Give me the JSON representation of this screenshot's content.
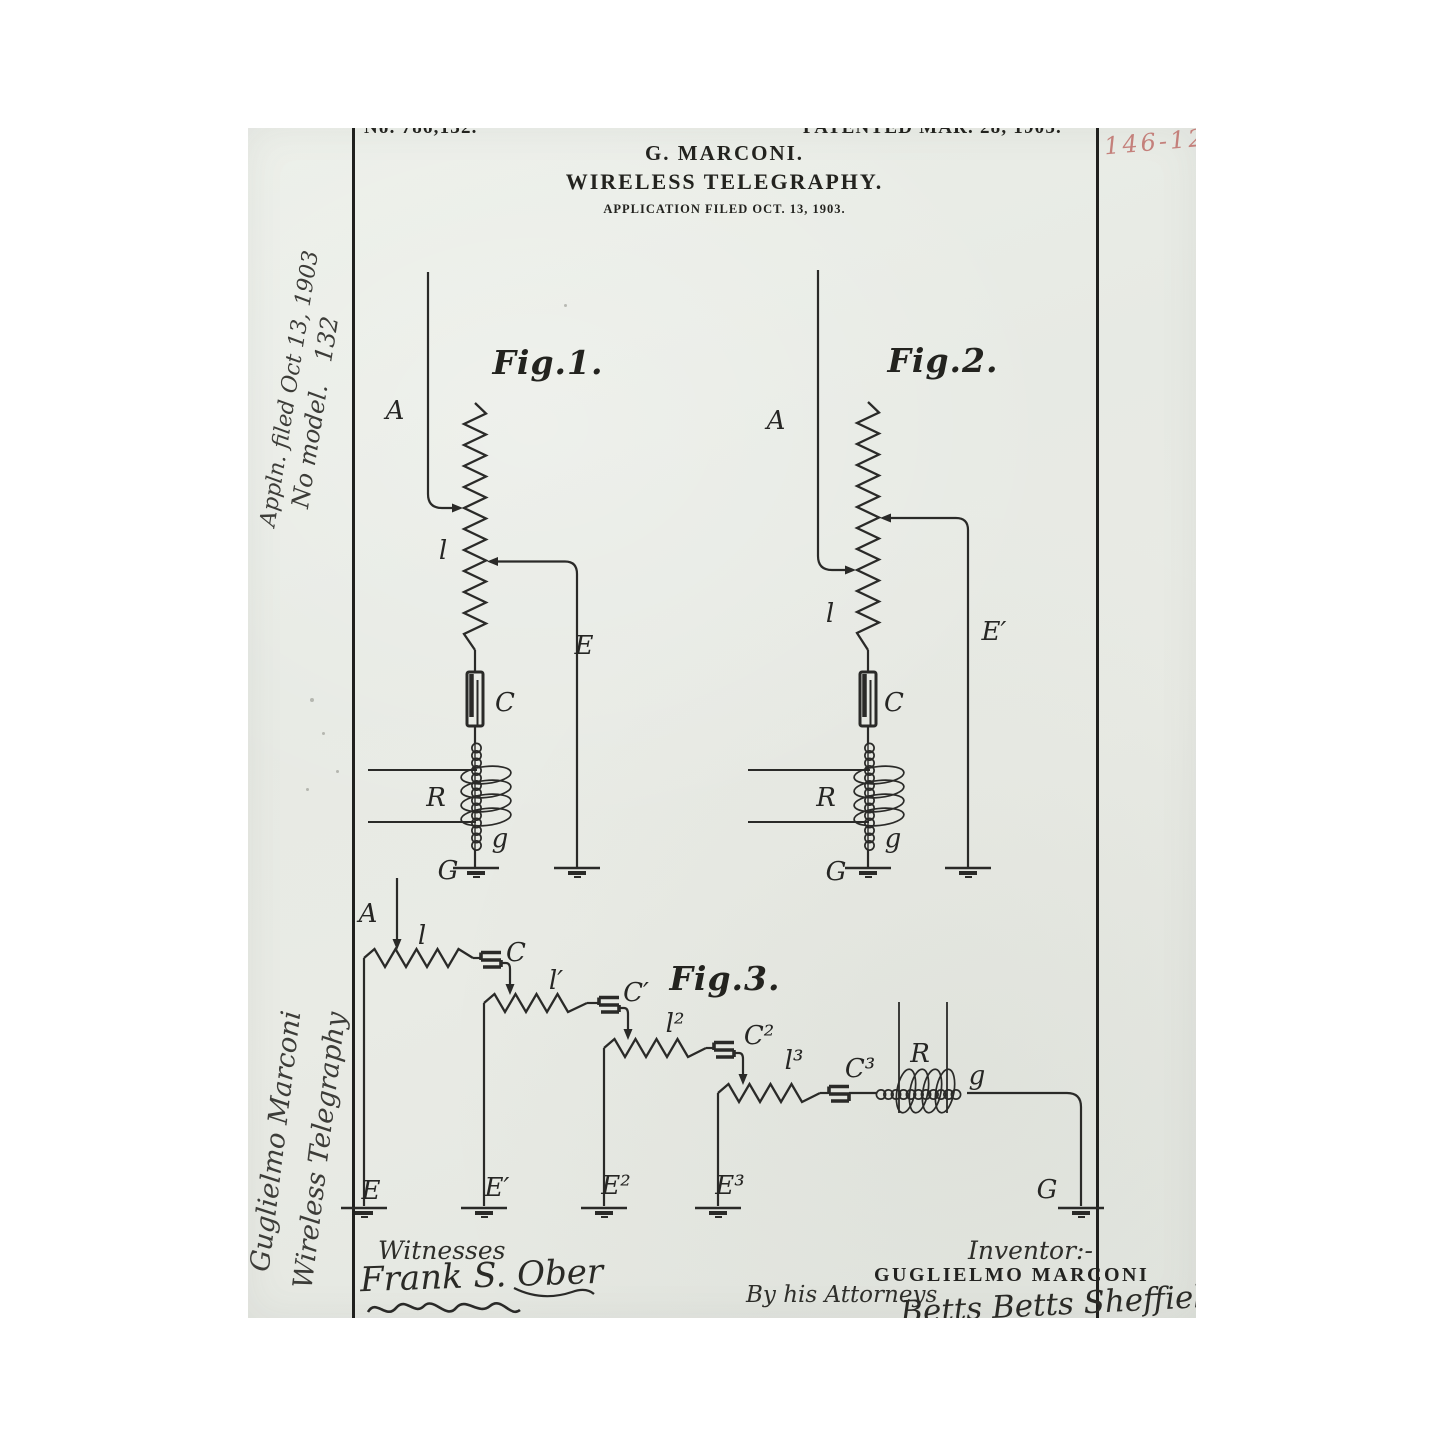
{
  "header": {
    "patent_number": "No. 786,132.",
    "patented_date": "PATENTED MAR. 28, 1905.",
    "applicant": "G. MARCONI.",
    "title": "WIRELESS TELEGRAPHY.",
    "application_note": "APPLICATION FILED OCT. 13, 1903.",
    "file_number_red": "146-12"
  },
  "margin": {
    "note_appln": "Appln. filed Oct 13, 1903",
    "note_model": "No model.   132",
    "note_name": "Guglielmo Marconi",
    "note_title": "Wireless Telegraphy"
  },
  "fig1": {
    "caption": "Fig.1.",
    "a": "A",
    "l": "l",
    "e": "E",
    "c": "C",
    "r": "R",
    "g": "g",
    "gnd": "G"
  },
  "fig2": {
    "caption": "Fig.2.",
    "a": "A",
    "l": "l",
    "e": "E′",
    "c": "C",
    "r": "R",
    "g": "g",
    "gnd": "G"
  },
  "fig3": {
    "caption": "Fig.3.",
    "a": "A",
    "l0": "l",
    "c0": "C",
    "l1": "l′",
    "c1": "C′",
    "l2": "l²",
    "c2": "C²",
    "l3": "l³",
    "c3": "C³",
    "r": "R",
    "g": "g",
    "e0": "E",
    "e1": "E′",
    "e2": "E²",
    "e3": "E³",
    "gnd": "G"
  },
  "footer": {
    "witnesses_label": "Witnesses",
    "witness_signature": "Frank S. Ober",
    "inventor_label": "Inventor:-",
    "inventor_name": "GUGLIELMO MARCONI",
    "attorneys_label": "By his Attorneys",
    "attorney_signature": "Betts Betts Sheffield Betts"
  }
}
